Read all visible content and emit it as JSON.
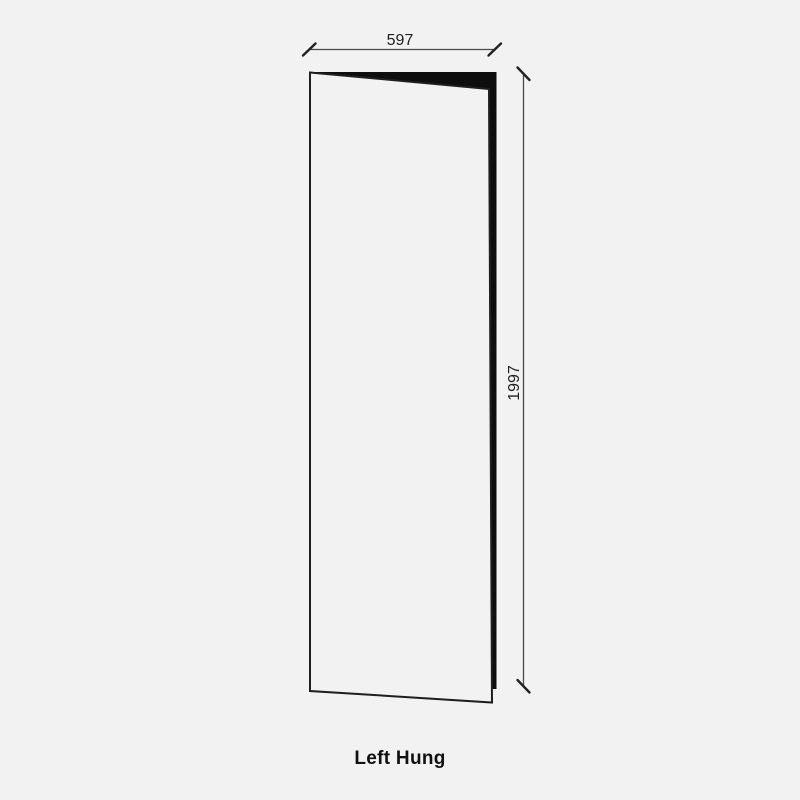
{
  "diagram": {
    "title": "Left Hung",
    "dimensions": {
      "width_mm": "597",
      "height_mm": "1997"
    },
    "colors": {
      "background": "#f2f2f2",
      "door_face_fill": "#f2f2f2",
      "door_outline": "#1f1f1f",
      "door_edge_fill": "#0e0e0e",
      "dimension_line": "#4a4a4a",
      "dimension_tick": "#222222",
      "text": "#212121"
    }
  }
}
